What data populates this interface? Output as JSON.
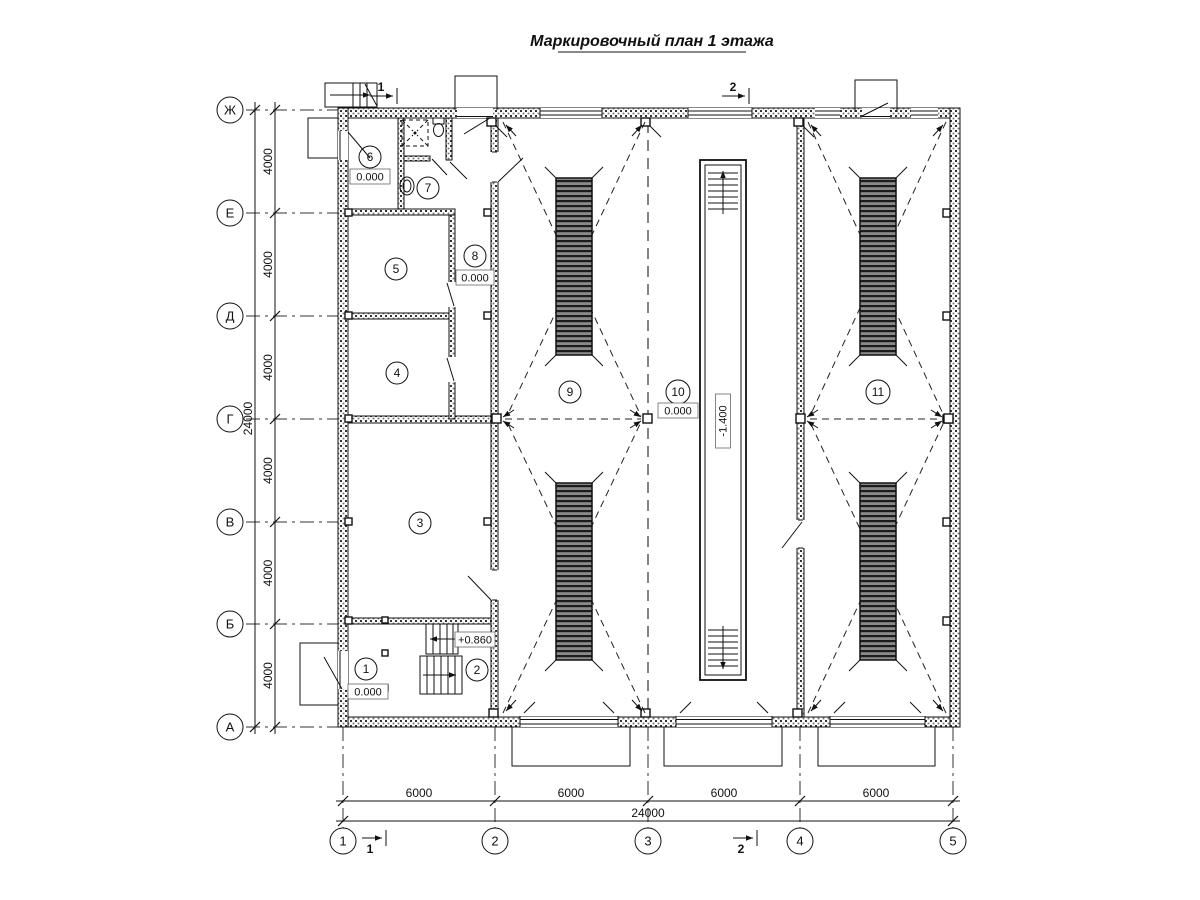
{
  "title": "Маркировочный план 1 этажа",
  "axes": {
    "rows": [
      {
        "label": "Ж"
      },
      {
        "label": "Е"
      },
      {
        "label": "Д"
      },
      {
        "label": "Г"
      },
      {
        "label": "В"
      },
      {
        "label": "Б"
      },
      {
        "label": "А"
      }
    ],
    "cols": [
      {
        "label": "1"
      },
      {
        "label": "2"
      },
      {
        "label": "3"
      },
      {
        "label": "4"
      },
      {
        "label": "5"
      }
    ]
  },
  "dimensions": {
    "left": {
      "segments": [
        "4000",
        "4000",
        "4000",
        "4000",
        "4000",
        "4000"
      ],
      "total": "24000"
    },
    "bottom": {
      "segments": [
        "6000",
        "6000",
        "6000",
        "6000"
      ],
      "total": "24000"
    }
  },
  "rooms": [
    {
      "number": "1",
      "elevation": "0.000"
    },
    {
      "number": "2",
      "elevation": "+0.860"
    },
    {
      "number": "3"
    },
    {
      "number": "4"
    },
    {
      "number": "5"
    },
    {
      "number": "6",
      "elevation": "0.000"
    },
    {
      "number": "7"
    },
    {
      "number": "8",
      "elevation": "0.000"
    },
    {
      "number": "9"
    },
    {
      "number": "10",
      "elevation": "0.000"
    },
    {
      "number": "11"
    }
  ],
  "pit": {
    "elevation": "-1.400"
  },
  "sections": [
    {
      "label": "1"
    },
    {
      "label": "2"
    }
  ]
}
